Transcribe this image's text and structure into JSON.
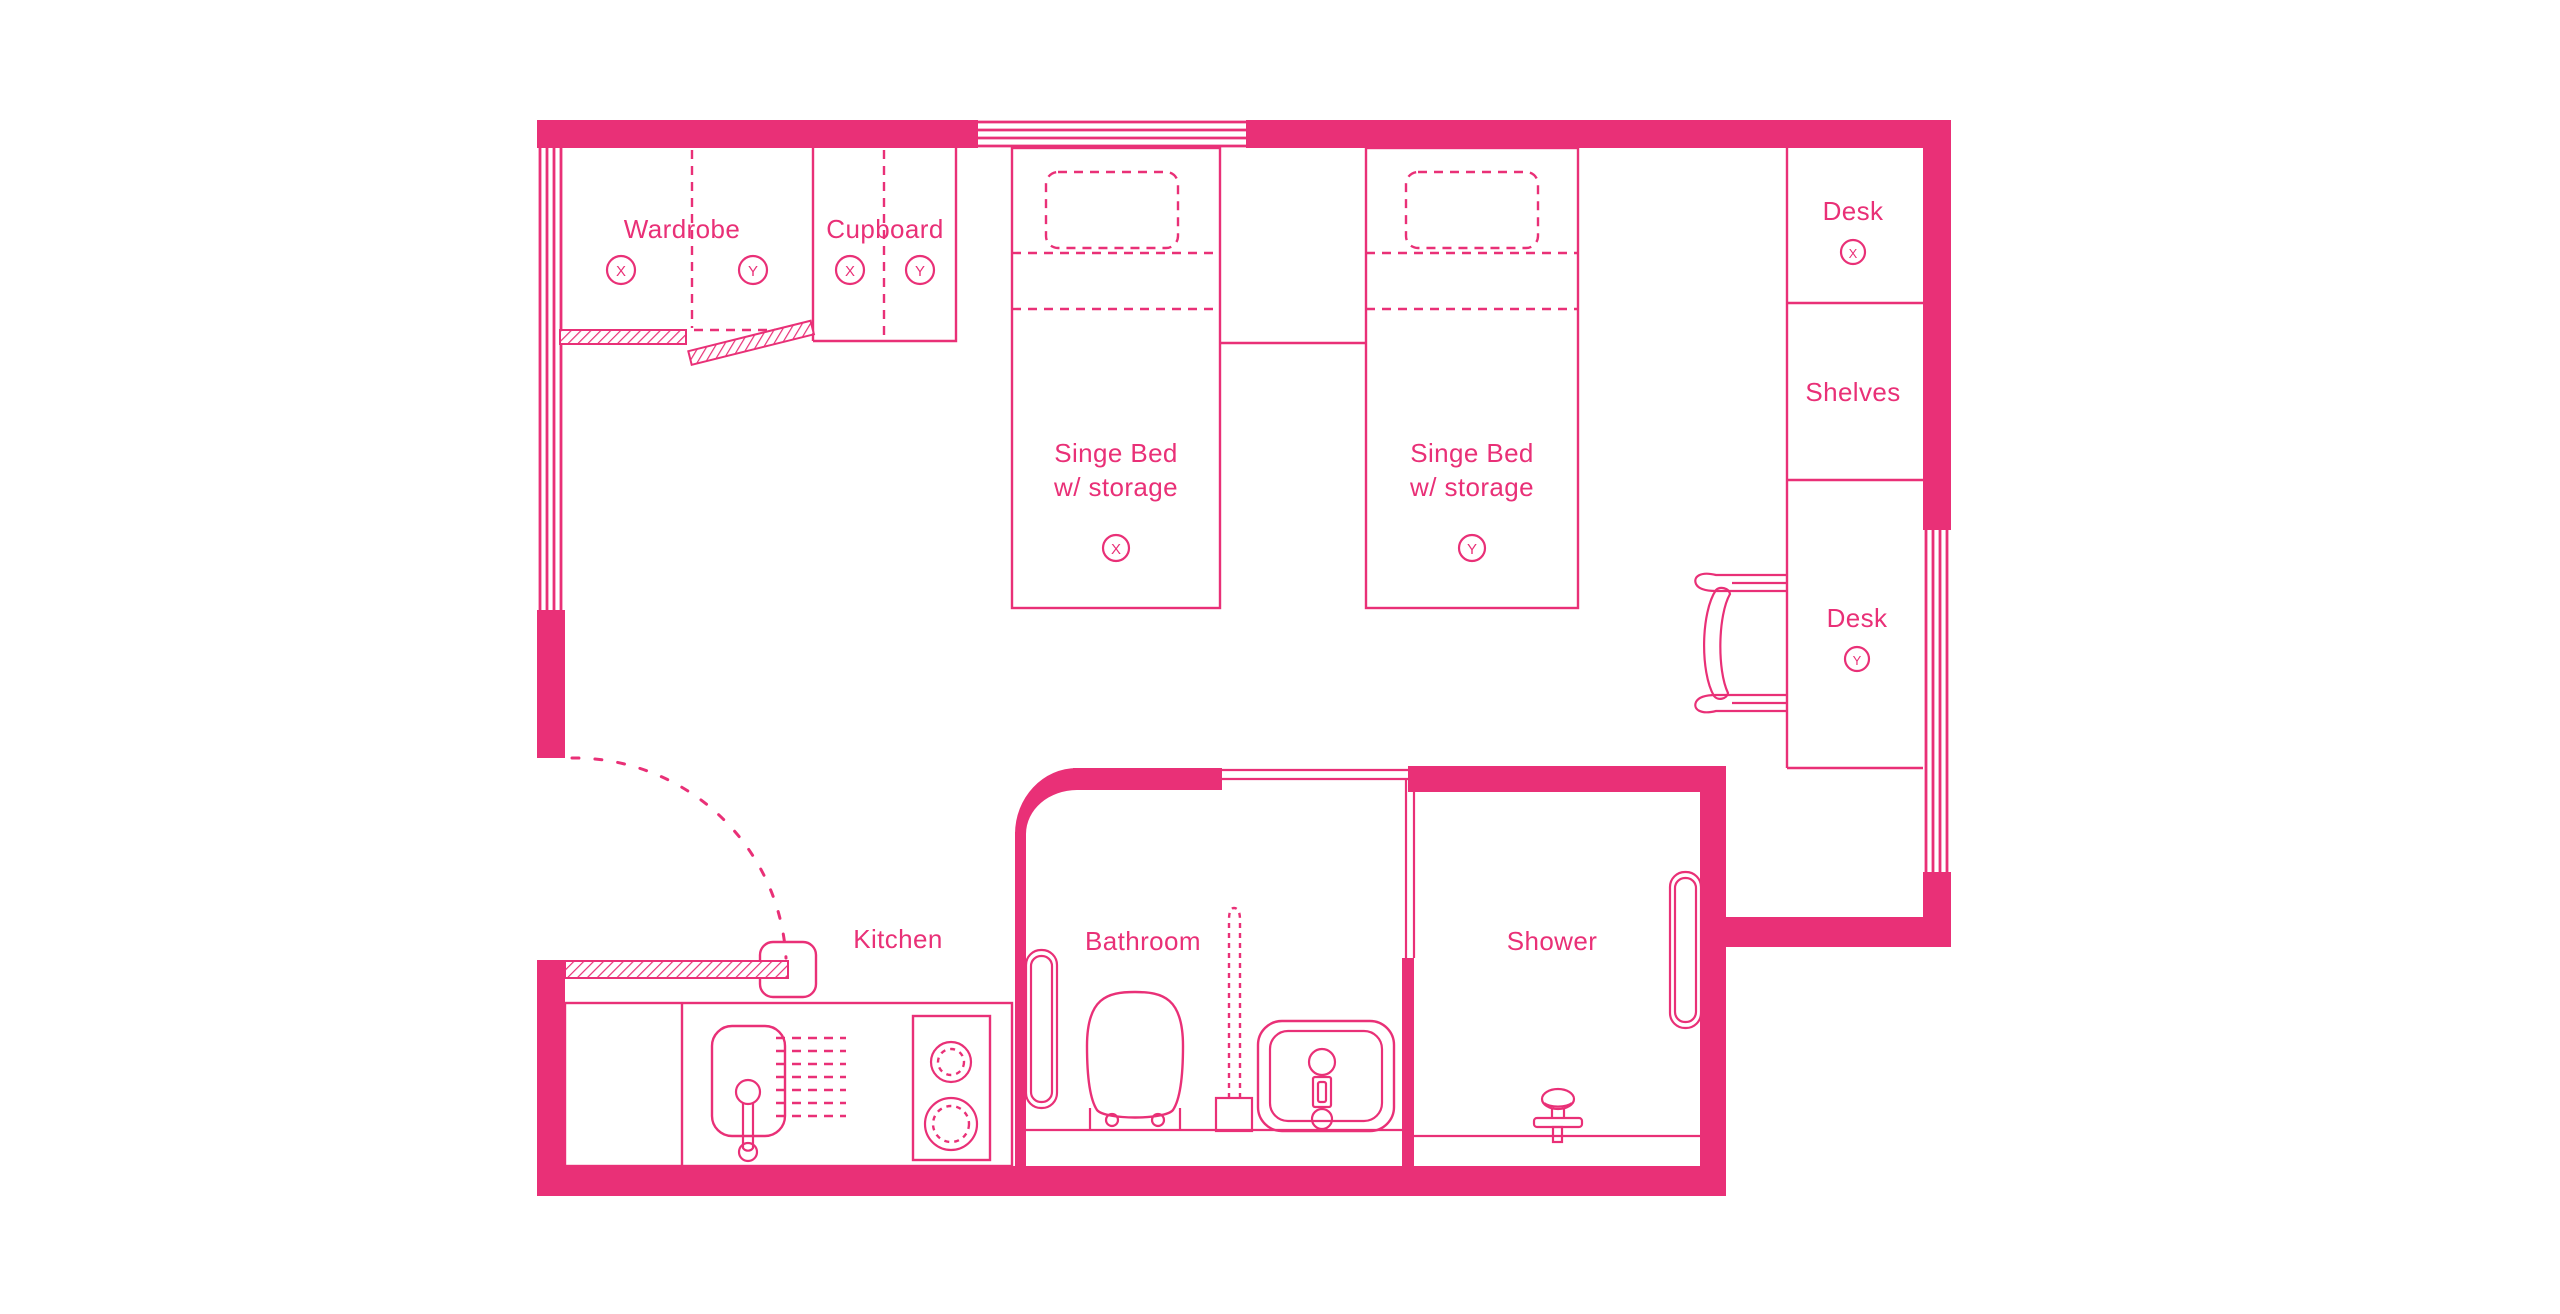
{
  "page": {
    "background": "#ffffff",
    "accent": "#e93077"
  },
  "floorplan": {
    "rooms": {
      "kitchen": {
        "label": "Kitchen"
      },
      "bathroom": {
        "label": "Bathroom"
      },
      "shower": {
        "label": "Shower"
      }
    },
    "storage": {
      "wardrobe": {
        "label": "Wardrobe",
        "marker_x": "X",
        "marker_y": "Y"
      },
      "cupboard": {
        "label": "Cupboard",
        "marker_x": "X",
        "marker_y": "Y"
      },
      "shelves": {
        "label": "Shelves"
      }
    },
    "beds": {
      "bed_x": {
        "line1": "Singe Bed",
        "line2": "w/ storage",
        "marker": "X"
      },
      "bed_y": {
        "line1": "Singe Bed",
        "line2": "w/ storage",
        "marker": "Y"
      }
    },
    "desks": {
      "desk_x": {
        "label": "Desk",
        "marker": "X"
      },
      "desk_y": {
        "label": "Desk",
        "marker": "Y"
      }
    }
  }
}
